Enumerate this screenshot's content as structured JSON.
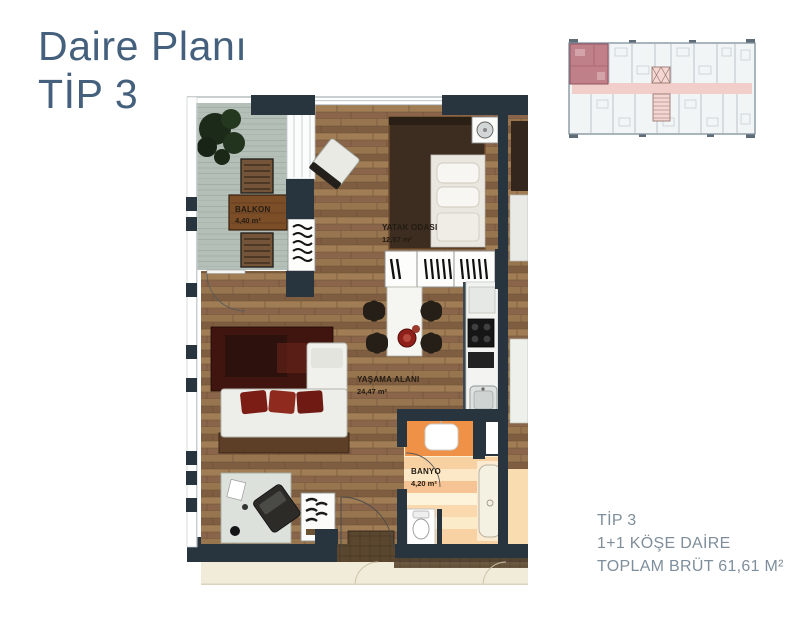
{
  "title": {
    "line1": "Daire Planı",
    "line2": "TİP 3"
  },
  "info": {
    "type": "TİP 3",
    "layout": "1+1 KÖŞE DAİRE",
    "gross": "TOPLAM BRÜT 61,61 M²"
  },
  "floorplan": {
    "rooms": [
      {
        "name": "BALKON",
        "area": "4,40 m²"
      },
      {
        "name": "YATAK ODASI",
        "area": "12,57 m²"
      },
      {
        "name": "YAŞAMA ALANI",
        "area": "24,47 m²"
      },
      {
        "name": "BANYO",
        "area": "4,20 m²"
      }
    ]
  },
  "keyplan": {
    "description": "floor key plan with highlighted corner unit"
  },
  "colors": {
    "title_text": "#44607d",
    "info_text": "#7e8e9b",
    "wall": "#28353f",
    "wood_floor": "#8d6a49",
    "balcony_floor": "#b4bfb8",
    "bathroom_accent": "#ef9146",
    "keyplan_highlight": "#c0808a",
    "keyplan_corridor": "#f1cec9"
  }
}
